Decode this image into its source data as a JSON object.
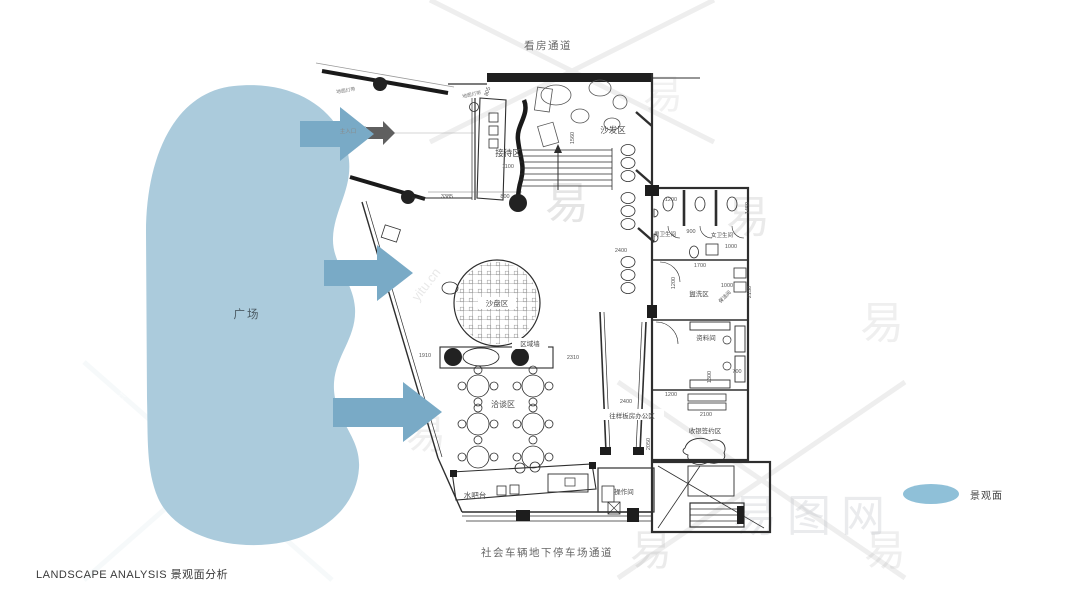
{
  "corridors": {
    "top": "看房通道",
    "bottom": "社会车辆地下停车场通道"
  },
  "footer": {
    "title": "LANDSCAPE ANALYSIS 景观面分析"
  },
  "plaza": {
    "label": "广场"
  },
  "legend": {
    "label": "景观面"
  },
  "colors": {
    "blob": "#abcbdc",
    "arrow": "#79aac6",
    "legend_swatch": "#8fc0d8",
    "plan_line": "#2e2e2e",
    "dim_text": "#555555",
    "room_text": "#4a4a4a"
  },
  "plan": {
    "rooms": [
      {
        "label": "接待区",
        "x": 508,
        "y": 156,
        "s": 8.5
      },
      {
        "label": "沙发区",
        "x": 613,
        "y": 133,
        "s": 8.5
      },
      {
        "label": "男卫生间",
        "x": 665,
        "y": 236,
        "s": 5.5
      },
      {
        "label": "女卫生间",
        "x": 722,
        "y": 237,
        "s": 5.5
      },
      {
        "label": "盥洗区",
        "x": 699,
        "y": 296,
        "s": 6.5
      },
      {
        "label": "保洁间",
        "x": 726,
        "y": 298,
        "s": 5,
        "rot": -45
      },
      {
        "label": "资料间",
        "x": 706,
        "y": 340,
        "s": 6.5
      },
      {
        "label": "沙盘区",
        "x": 497,
        "y": 306,
        "s": 7.5
      },
      {
        "label": "区域墙",
        "x": 530,
        "y": 346,
        "s": 6.5
      },
      {
        "label": "洽谈区",
        "x": 503,
        "y": 407,
        "s": 8
      },
      {
        "label": "往样板房办公区",
        "x": 632,
        "y": 418,
        "s": 6.5
      },
      {
        "label": "收银签约区",
        "x": 705,
        "y": 433,
        "s": 6.5
      },
      {
        "label": "水吧台",
        "x": 475,
        "y": 498,
        "s": 7.5
      },
      {
        "label": "操作间",
        "x": 624,
        "y": 494,
        "s": 6.5
      },
      {
        "label": "主入口",
        "x": 348,
        "y": 133,
        "s": 5.5,
        "c": "#8a8a8a"
      },
      {
        "label": "地面灯带",
        "x": 346,
        "y": 92,
        "s": 4.8,
        "rot": -9,
        "c": "#777777"
      },
      {
        "label": "地面灯带",
        "x": 472,
        "y": 96,
        "s": 4.8,
        "rot": -12,
        "c": "#777777"
      }
    ],
    "dims": [
      {
        "v": "3385",
        "x": 447,
        "y": 198
      },
      {
        "v": "1100",
        "x": 508,
        "y": 168
      },
      {
        "v": "800",
        "x": 505,
        "y": 198
      },
      {
        "v": "805",
        "x": 489,
        "y": 92,
        "rot": -72
      },
      {
        "v": "1560",
        "x": 574,
        "y": 138,
        "rot": -90
      },
      {
        "v": "1910",
        "x": 425,
        "y": 357
      },
      {
        "v": "2310",
        "x": 573,
        "y": 359
      },
      {
        "v": "2400",
        "x": 621,
        "y": 252
      },
      {
        "v": "2400",
        "x": 626,
        "y": 403
      },
      {
        "v": "1200",
        "x": 671,
        "y": 201
      },
      {
        "v": "900",
        "x": 691,
        "y": 233
      },
      {
        "v": "1450",
        "x": 749,
        "y": 208,
        "rot": -90
      },
      {
        "v": "1000",
        "x": 731,
        "y": 248
      },
      {
        "v": "1700",
        "x": 700,
        "y": 267
      },
      {
        "v": "1200",
        "x": 675,
        "y": 283,
        "rot": -90
      },
      {
        "v": "1000",
        "x": 727,
        "y": 287
      },
      {
        "v": "2150",
        "x": 751,
        "y": 292,
        "rot": -90
      },
      {
        "v": "1300",
        "x": 711,
        "y": 377,
        "rot": -90
      },
      {
        "v": "700",
        "x": 737,
        "y": 373
      },
      {
        "v": "1200",
        "x": 671,
        "y": 396
      },
      {
        "v": "2100",
        "x": 706,
        "y": 416
      },
      {
        "v": "2050",
        "x": 650,
        "y": 444,
        "rot": -90
      }
    ]
  },
  "watermarks": {
    "yi_char": "易",
    "url": "yitu.cn",
    "brand": "易图网",
    "yi": [
      {
        "x": 78,
        "y": 322,
        "s": 46,
        "c": "rgba(255,255,255,0.50)"
      },
      {
        "x": 220,
        "y": 556,
        "s": 42,
        "c": "rgba(255,255,255,0.50)"
      },
      {
        "x": 308,
        "y": 348,
        "s": 40,
        "c": "rgba(150,150,150,0.22)"
      },
      {
        "x": 545,
        "y": 218,
        "s": 44,
        "c": "rgba(150,150,150,0.25)"
      },
      {
        "x": 726,
        "y": 232,
        "s": 44,
        "c": "rgba(160,160,160,0.22)"
      },
      {
        "x": 860,
        "y": 338,
        "s": 44,
        "c": "rgba(175,175,175,0.20)"
      },
      {
        "x": 406,
        "y": 448,
        "s": 40,
        "c": "rgba(175,175,175,0.20)"
      },
      {
        "x": 630,
        "y": 565,
        "s": 42,
        "c": "rgba(170,170,170,0.24)"
      },
      {
        "x": 864,
        "y": 565,
        "s": 42,
        "c": "rgba(175,175,175,0.20)"
      },
      {
        "x": 643,
        "y": 108,
        "s": 40,
        "c": "rgba(185,185,185,0.20)"
      }
    ],
    "url_marks": [
      {
        "x": 298,
        "y": 348,
        "rot": -52,
        "s": 15,
        "c": "rgba(140,140,140,0.28)"
      },
      {
        "x": 196,
        "y": 444,
        "rot": -52,
        "s": 15,
        "c": "rgba(255,255,255,0.55)"
      },
      {
        "x": 106,
        "y": 422,
        "rot": -52,
        "s": 13,
        "c": "rgba(255,255,255,0.50)"
      },
      {
        "x": 418,
        "y": 302,
        "rot": -52,
        "s": 13,
        "c": "rgba(150,150,150,0.22)"
      }
    ],
    "brand_pos": {
      "x": 733,
      "y": 531,
      "s": 44,
      "c": "rgba(185,190,195,0.30)"
    }
  }
}
